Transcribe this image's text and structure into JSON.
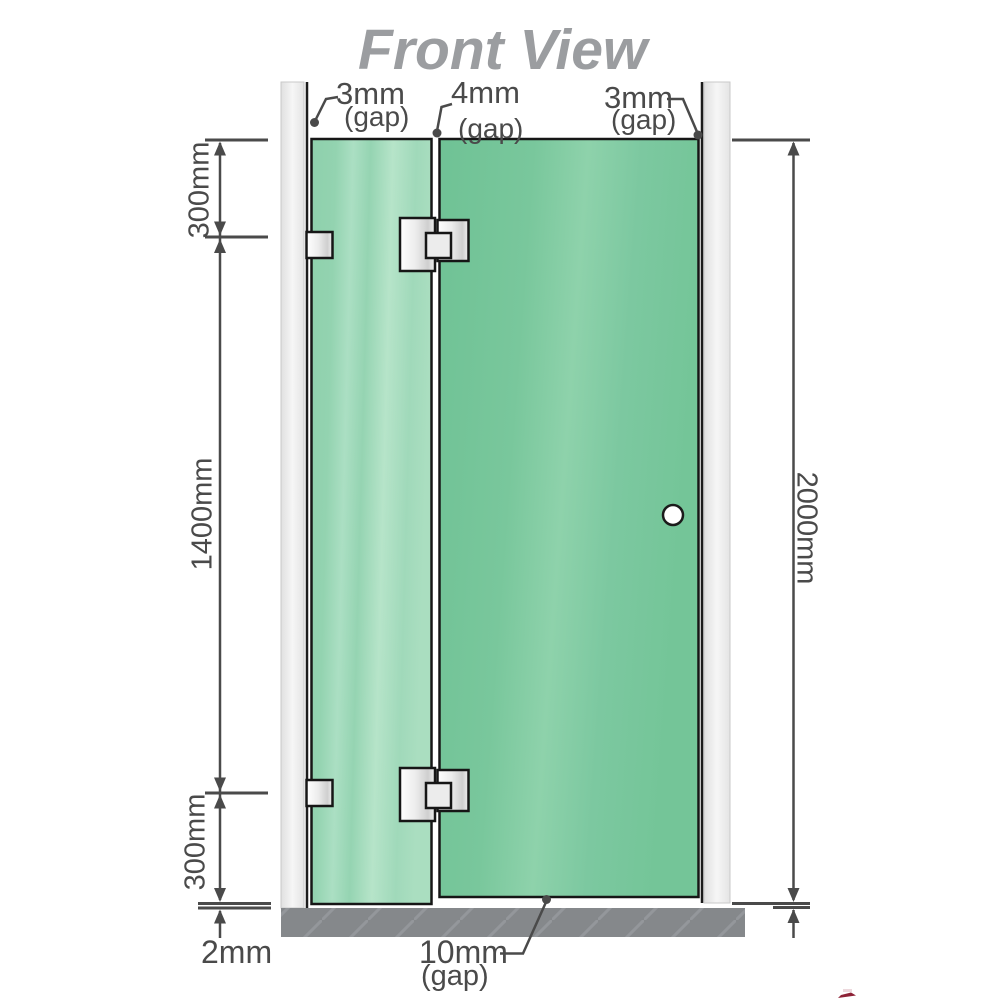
{
  "title": "Front View",
  "diagram": {
    "top_gap_labels": [
      {
        "value": "3mm",
        "suffix": "(gap)"
      },
      {
        "value": "4mm",
        "suffix": "(gap)"
      },
      {
        "value": "3mm",
        "suffix": "(gap)"
      }
    ],
    "left_dimensions": {
      "top": "300mm",
      "middle": "1400mm",
      "bottom": "300mm"
    },
    "right_dimension": "2000mm",
    "floor_gap": "2mm",
    "door_bottom_gap": {
      "value": "10mm",
      "suffix": "(gap)"
    }
  },
  "colors": {
    "title_gray": "#9b9da0",
    "dimension_gray": "#4a4a4a",
    "glass_fixed_green": "#9ad4b4",
    "glass_door_green": "#7bc7a0",
    "wall_channel_gray": "#ebebeb",
    "floor_gray": "#85888b",
    "hardware_metal": "#e8e8e8",
    "watermark_red": "#8e2236"
  }
}
